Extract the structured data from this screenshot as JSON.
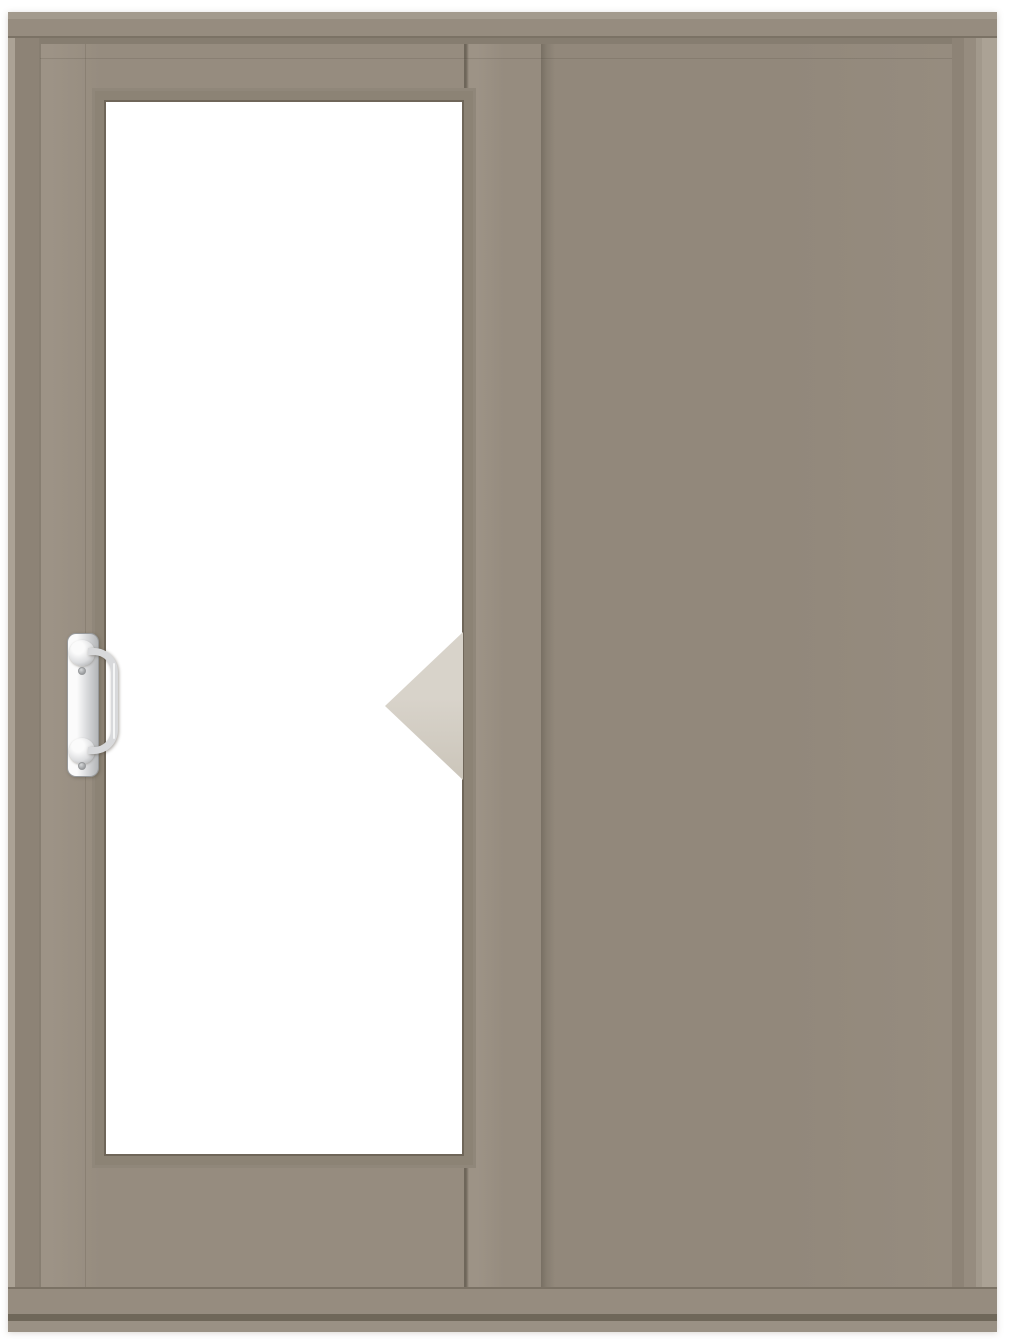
{
  "scene": {
    "subject": "two-panel-sliding-patio-door",
    "left_panel": "operating-panel-with-handle",
    "right_panel": "fixed-panel",
    "slide_direction": "left"
  },
  "icons": {
    "arrow": "slide-direction-left-arrow",
    "handle": "door-pull-handle"
  },
  "colors": {
    "page_bg": "#ffffff",
    "frame_edge_light": "#aba295",
    "frame_head_top": "#a39a8d",
    "frame": "#968c7f",
    "jamb": "#8d8376",
    "jamb_right_outer": "#a2998c",
    "inner_shadow": "#867d70",
    "panel": "#968c7f",
    "panel_right": "#92887b",
    "stile_light": "#9d9386",
    "sliver_dark": "#6e665a",
    "bead": "#8c8375",
    "bead_outer": "#90877a",
    "glass": "#ffffff",
    "glass_edge": "#6f6659",
    "line_dark": "#7b7265",
    "line_soft": "#877e71",
    "sill_dark": "#6f6759",
    "sill_bottom": "#9a9184",
    "arrow_top": "#d8d3ca",
    "arrow_bottom": "#cbc5ba",
    "handle_plate_hi": "#fbfbfb",
    "handle_plate_mid": "#dcdddf",
    "handle_plate_lo": "#b4b6b8",
    "handle_metal": "#d8d9db",
    "handle_metal_dark": "#97999b",
    "screw": "#85878a"
  }
}
